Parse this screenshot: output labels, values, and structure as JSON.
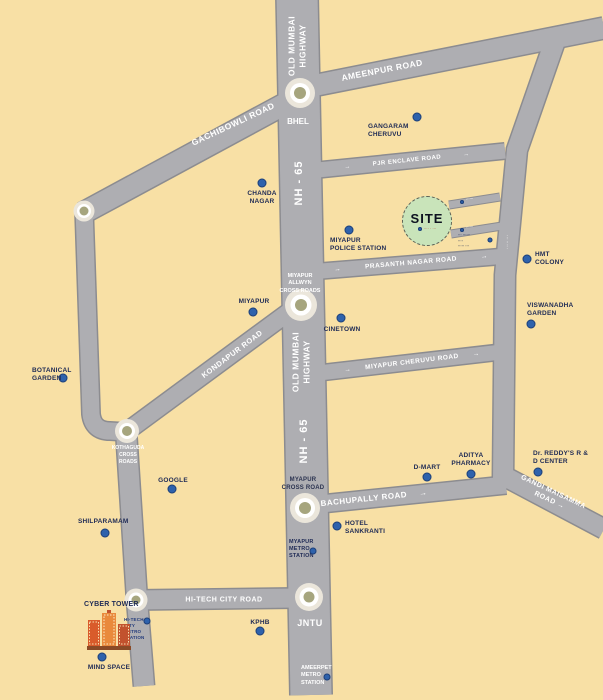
{
  "colors": {
    "background": "#F8E0A5",
    "road": "#AEAEB2",
    "road_casing": "#8C8C90",
    "poi_label": "#1E2A55",
    "road_label": "#FFFFFF",
    "marker_blue": "#2E62AC",
    "junction_center_olive": "#A6A57E",
    "site_fill": "#C9E4BA"
  },
  "glyphs": {
    "arrow_right": "→"
  },
  "highway": {
    "old_mumbai_line1": "OLD MUMBAI",
    "old_mumbai_line2": "HIGHWAY",
    "nh65": "NH - 65"
  },
  "roads": {
    "ameenpur": "AMEENPUR ROAD",
    "gachibowli": "GACHIBOWLI ROAD",
    "kondapur": "KONDAPUR ROAD",
    "pjr_enclave": "PJR ENCLAVE ROAD",
    "prasanth_nagar": "PRASANTH NAGAR ROAD",
    "miyapur_cheruvu": "MIYAPUR CHERUVU ROAD",
    "bachupally": "BACHUPALLY ROAD",
    "gandi_maisamma_line1": "GANDI MAISAMMA",
    "gandi_maisamma_line2": "ROAD",
    "hitech_city": "HI-TECH CITY ROAD"
  },
  "junctions": {
    "bhel": "BHEL",
    "miyapur_allwyn_line1": "MIYAPUR ALLWYN",
    "miyapur_allwyn_line2": "CROSS ROADS",
    "kothaguda_line1": "KOTHAGUDA",
    "kothaguda_line2": "CROSS",
    "kothaguda_line3": "ROADS",
    "myapur_cross_line1": "MYAPUR",
    "myapur_cross_line2": "CROSS ROAD",
    "jntu": "JNTU"
  },
  "stations": {
    "myapur_metro": [
      "MYAPUR",
      "METRO",
      "STATION"
    ],
    "ameerpet_metro": [
      "AMEERPET",
      "METRO",
      "STATION"
    ],
    "hitec_metro": [
      "HI-TECH CITY",
      "METRO",
      "STATION"
    ]
  },
  "pois": {
    "gangaram_cheruvu": "GANGARAM CHERUVU",
    "chanda_nagar": "CHANDA NAGAR",
    "miyapur_police": "MIYAPUR POLICE STATION",
    "hmt_colony": "HMT COLONY",
    "viswanadha_garden": "VISWANADHA GARDEN",
    "miyapur": "MIYAPUR",
    "cinetown": "CINETOWN",
    "botanical_garden": "BOTANICAL GARDEN",
    "google": "GOOGLE",
    "shilparamam": "SHILPARAMAM",
    "cyber_tower": "CYBER TOWER",
    "mind_space": "MIND SPACE",
    "kphb": "KPHB",
    "d_mart": "D-MART",
    "aditya_pharmacy": "ADITYA PHARMACY",
    "dr_reddys": "Dr. REDDY'S R & D CENTER",
    "hotel_sankranti": "HOTEL SANKRANTI"
  },
  "site": {
    "label": "SITE",
    "sublabel_illegible": "···· · ···"
  },
  "micro_illegible": {
    "stub1": "······",
    "stub2": "······",
    "cluster_line1": "··· ······",
    "cluster_line2": "····",
    "cluster_line3": "····· ···",
    "vertical_road": "· ·· ·· ·· ·"
  }
}
